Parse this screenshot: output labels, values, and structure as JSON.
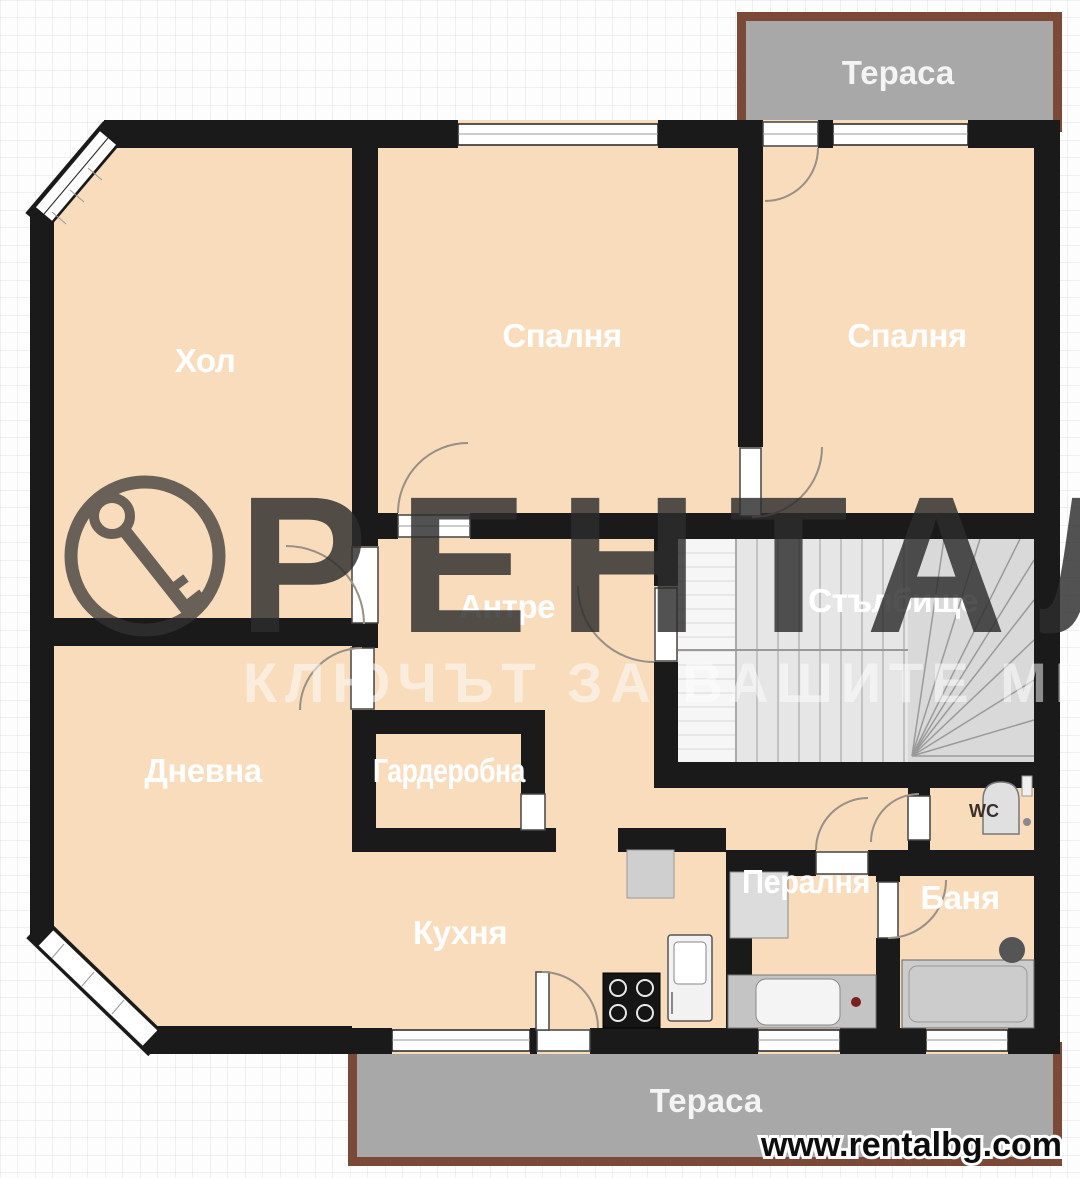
{
  "rooms": {
    "hol": "Хол",
    "bedroom_mid": "Спалня",
    "bedroom_right": "Спалня",
    "antre": "Антре",
    "staircase": "Стълбище",
    "dnevna": "Дневна",
    "garderobna": "Гардеробна",
    "kitchen": "Кухня",
    "laundry": "Пералня",
    "bathroom": "Баня",
    "wc": "WC",
    "terrace_top": "Тераса",
    "terrace_bottom": "Тераса"
  },
  "watermark": {
    "brand": "РЕНТАЛ",
    "slogan": "КЛЮЧЪТ ЗА ВАШИТЕ МЕЧТИ"
  },
  "footer": {
    "website": "www.rentalbg.com"
  },
  "colors": {
    "floor": "#F8DCBC",
    "wall": "#1A1A1A",
    "terrace_fill": "#A8A8A8",
    "terrace_border": "#7B4938",
    "stair_fill": "#E6E6E6",
    "stair_winder": "#D9D9D9",
    "grid_line": "#E2E2E2",
    "background": "#FDFDFD",
    "room_label": "#FFFFFF",
    "wc_label": "#3A3028",
    "watermark_dark": "#2D2D2D",
    "watermark_light": "#FFFFFF",
    "website_text": "#0D0D0D"
  }
}
